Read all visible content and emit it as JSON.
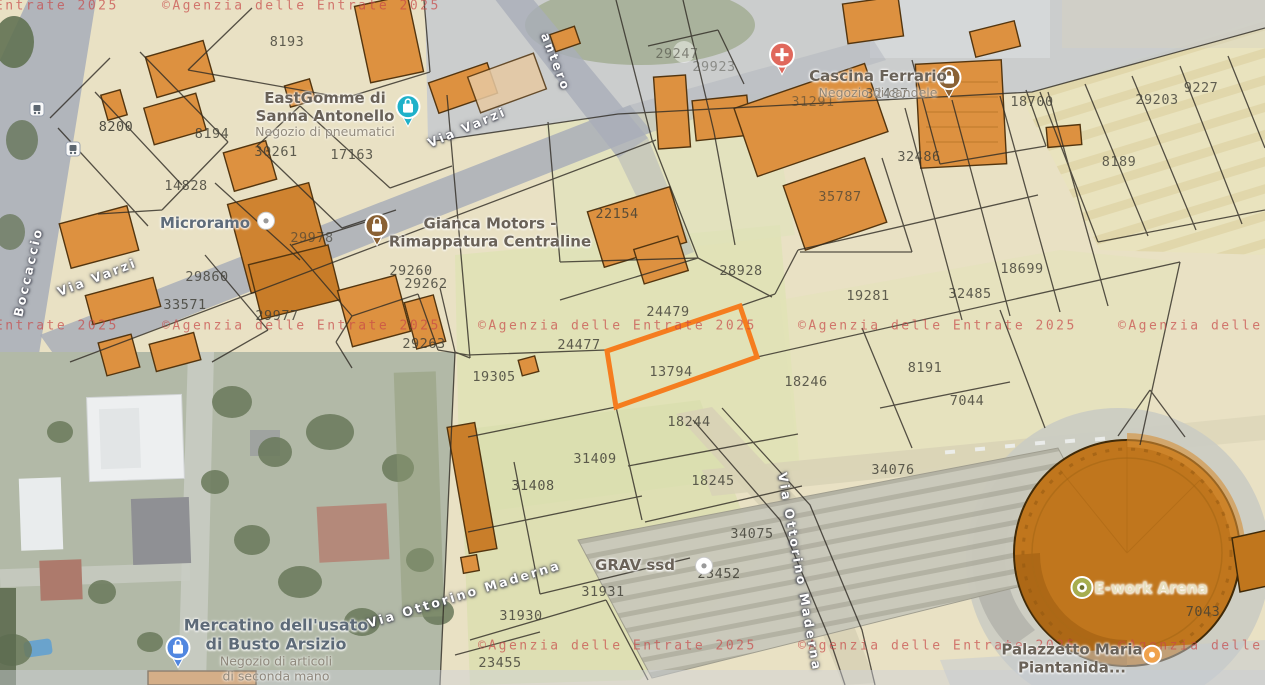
{
  "app": {
    "title": "Cadastral parcel map overlay (Agenzia delle Entrate on satellite map)"
  },
  "colors": {
    "highlight": "#f57d1f",
    "watermark": "#c84848",
    "parceltext": "#3f3e35",
    "streettext": "#ffffff",
    "poititle": "#6a6258",
    "poisub": "#8c8478",
    "pinTeal": "#1fb1c9",
    "pinBlue": "#5187e0",
    "pinBrown": "#8a6134",
    "pinRed": "#e0685c",
    "pinOlive": "#a6ad4e",
    "pinOrange": "#f0a24c",
    "buildingFill": "#dd9140",
    "arenaFill": "#c0761d"
  },
  "watermark": {
    "text": "©Agenzia delle Entrate 2025",
    "positions": [
      {
        "x": -160,
        "y": 6
      },
      {
        "x": 162,
        "y": 6
      },
      {
        "x": -160,
        "y": 326
      },
      {
        "x": 162,
        "y": 326
      },
      {
        "x": 478,
        "y": 326
      },
      {
        "x": 798,
        "y": 326
      },
      {
        "x": 1118,
        "y": 326
      },
      {
        "x": 478,
        "y": 646
      },
      {
        "x": 798,
        "y": 646
      },
      {
        "x": 1118,
        "y": 646
      }
    ]
  },
  "highlighted_parcel": {
    "n": "13794",
    "points": "607,351 740,306 757,357 616,407"
  },
  "parcels": [
    {
      "n": "8193",
      "x": 287,
      "y": 42
    },
    {
      "n": "8200",
      "x": 116,
      "y": 127,
      "op": 0.9
    },
    {
      "n": "8194",
      "x": 212,
      "y": 134
    },
    {
      "n": "30261",
      "x": 276,
      "y": 152
    },
    {
      "n": "17163",
      "x": 352,
      "y": 155
    },
    {
      "n": "14828",
      "x": 186,
      "y": 186
    },
    {
      "n": "29247",
      "x": 677,
      "y": 54,
      "op": 0.55
    },
    {
      "n": "29923",
      "x": 714,
      "y": 67,
      "op": 0.45
    },
    {
      "n": "31291",
      "x": 813,
      "y": 102,
      "op": 0.55
    },
    {
      "n": "32487",
      "x": 887,
      "y": 94,
      "op": 0.75
    },
    {
      "n": "32486",
      "x": 919,
      "y": 157
    },
    {
      "n": "18700",
      "x": 1032,
      "y": 102
    },
    {
      "n": "9227",
      "x": 1201,
      "y": 88,
      "op": 0.8
    },
    {
      "n": "29203",
      "x": 1157,
      "y": 100,
      "op": 0.8
    },
    {
      "n": "8189",
      "x": 1119,
      "y": 162,
      "op": 0.8
    },
    {
      "n": "35787",
      "x": 840,
      "y": 197,
      "op": 0.7
    },
    {
      "n": "22154",
      "x": 617,
      "y": 214
    },
    {
      "n": "29978",
      "x": 312,
      "y": 238,
      "op": 0.65
    },
    {
      "n": "29860",
      "x": 207,
      "y": 277,
      "op": 0.8
    },
    {
      "n": "33571",
      "x": 185,
      "y": 305
    },
    {
      "n": "29977",
      "x": 277,
      "y": 316
    },
    {
      "n": "29260",
      "x": 411,
      "y": 271
    },
    {
      "n": "29262",
      "x": 426,
      "y": 284
    },
    {
      "n": "29263",
      "x": 424,
      "y": 344
    },
    {
      "n": "28928",
      "x": 741,
      "y": 271
    },
    {
      "n": "18699",
      "x": 1022,
      "y": 269
    },
    {
      "n": "19281",
      "x": 868,
      "y": 296
    },
    {
      "n": "32485",
      "x": 970,
      "y": 294
    },
    {
      "n": "24479",
      "x": 668,
      "y": 312
    },
    {
      "n": "24477",
      "x": 579,
      "y": 345
    },
    {
      "n": "13794",
      "x": 671,
      "y": 372
    },
    {
      "n": "19305",
      "x": 494,
      "y": 377
    },
    {
      "n": "18246",
      "x": 806,
      "y": 382
    },
    {
      "n": "8191",
      "x": 925,
      "y": 368
    },
    {
      "n": "7044",
      "x": 967,
      "y": 401
    },
    {
      "n": "18244",
      "x": 689,
      "y": 422
    },
    {
      "n": "31409",
      "x": 595,
      "y": 459
    },
    {
      "n": "31408",
      "x": 533,
      "y": 486,
      "op": 0.85
    },
    {
      "n": "18245",
      "x": 713,
      "y": 481
    },
    {
      "n": "34075",
      "x": 752,
      "y": 534
    },
    {
      "n": "34076",
      "x": 893,
      "y": 470
    },
    {
      "n": "23452",
      "x": 719,
      "y": 574,
      "op": 0.85
    },
    {
      "n": "31931",
      "x": 603,
      "y": 592
    },
    {
      "n": "31930",
      "x": 521,
      "y": 616
    },
    {
      "n": "23455",
      "x": 500,
      "y": 663
    },
    {
      "n": "7043",
      "x": 1203,
      "y": 612
    }
  ],
  "pois": [
    {
      "id": "eastgomme",
      "lines": [
        "EastGomme di",
        "Sanna Antonello",
        "Negozio di pneumatici"
      ],
      "titleLines": 2,
      "x": 325,
      "y": 115,
      "pin": "shop-teal",
      "pinX": 408,
      "pinY": 112
    },
    {
      "id": "microramo",
      "lines": [
        "Microramo"
      ],
      "titleLines": 1,
      "x": 205,
      "y": 224,
      "color": "#5f6c7a",
      "pin": "dot-white",
      "pinX": 266,
      "pinY": 222
    },
    {
      "id": "gianca",
      "lines": [
        "Gianca Motors -",
        "Rimappatura Centraline"
      ],
      "titleLines": 2,
      "x": 490,
      "y": 233,
      "pin": "lock-brown",
      "pinX": 377,
      "pinY": 231
    },
    {
      "id": "cascina",
      "lines": [
        "Cascina Ferrario",
        "Negozio di candele"
      ],
      "titleLines": 1,
      "x": 878,
      "y": 84,
      "pin": "lock-brown",
      "pinX": 949,
      "pinY": 83
    },
    {
      "id": "health",
      "lines": [],
      "titleLines": 0,
      "x": 782,
      "y": 60,
      "pin": "cross-red",
      "pinX": 782,
      "pinY": 60
    },
    {
      "id": "mercatino",
      "lines": [
        "Mercatino dell'usato",
        "di Busto Arsizio",
        "Negozio di articoli",
        "di seconda mano"
      ],
      "titleLines": 2,
      "x": 276,
      "y": 650,
      "color": "#5d6a78",
      "big": true,
      "pin": "shop-blue",
      "pinX": 178,
      "pinY": 653
    },
    {
      "id": "grav",
      "lines": [
        "GRAV ssd"
      ],
      "titleLines": 1,
      "x": 635,
      "y": 566,
      "pin": "dot-white",
      "pinX": 704,
      "pinY": 567
    },
    {
      "id": "arena",
      "lines": [
        "E-work Arena"
      ],
      "titleLines": 1,
      "x": 1151,
      "y": 589,
      "color": "#e8e0c0",
      "dark": true,
      "pin": "dot-olive",
      "pinX": 1082,
      "pinY": 589
    },
    {
      "id": "palazzetto",
      "lines": [
        "Palazzetto Maria",
        "Piantanida..."
      ],
      "titleLines": 2,
      "x": 1072,
      "y": 659,
      "pin": "dot-orange",
      "pinX": 1152,
      "pinY": 656
    }
  ],
  "streets": [
    {
      "name": "Via Varzi",
      "x": 97,
      "y": 277,
      "rot": -21
    },
    {
      "name": "Via Varzi",
      "x": 467,
      "y": 127,
      "rot": -23
    },
    {
      "name": "antero",
      "x": 556,
      "y": 62,
      "rot": 69
    },
    {
      "name": "Boccaccio",
      "x": 28,
      "y": 272,
      "rot": -77
    },
    {
      "name": "Via Ottorino Maderna",
      "x": 800,
      "y": 572,
      "rot": 80
    },
    {
      "name": "Via Ottorino Maderna",
      "x": 464,
      "y": 594,
      "rot": -17
    }
  ]
}
